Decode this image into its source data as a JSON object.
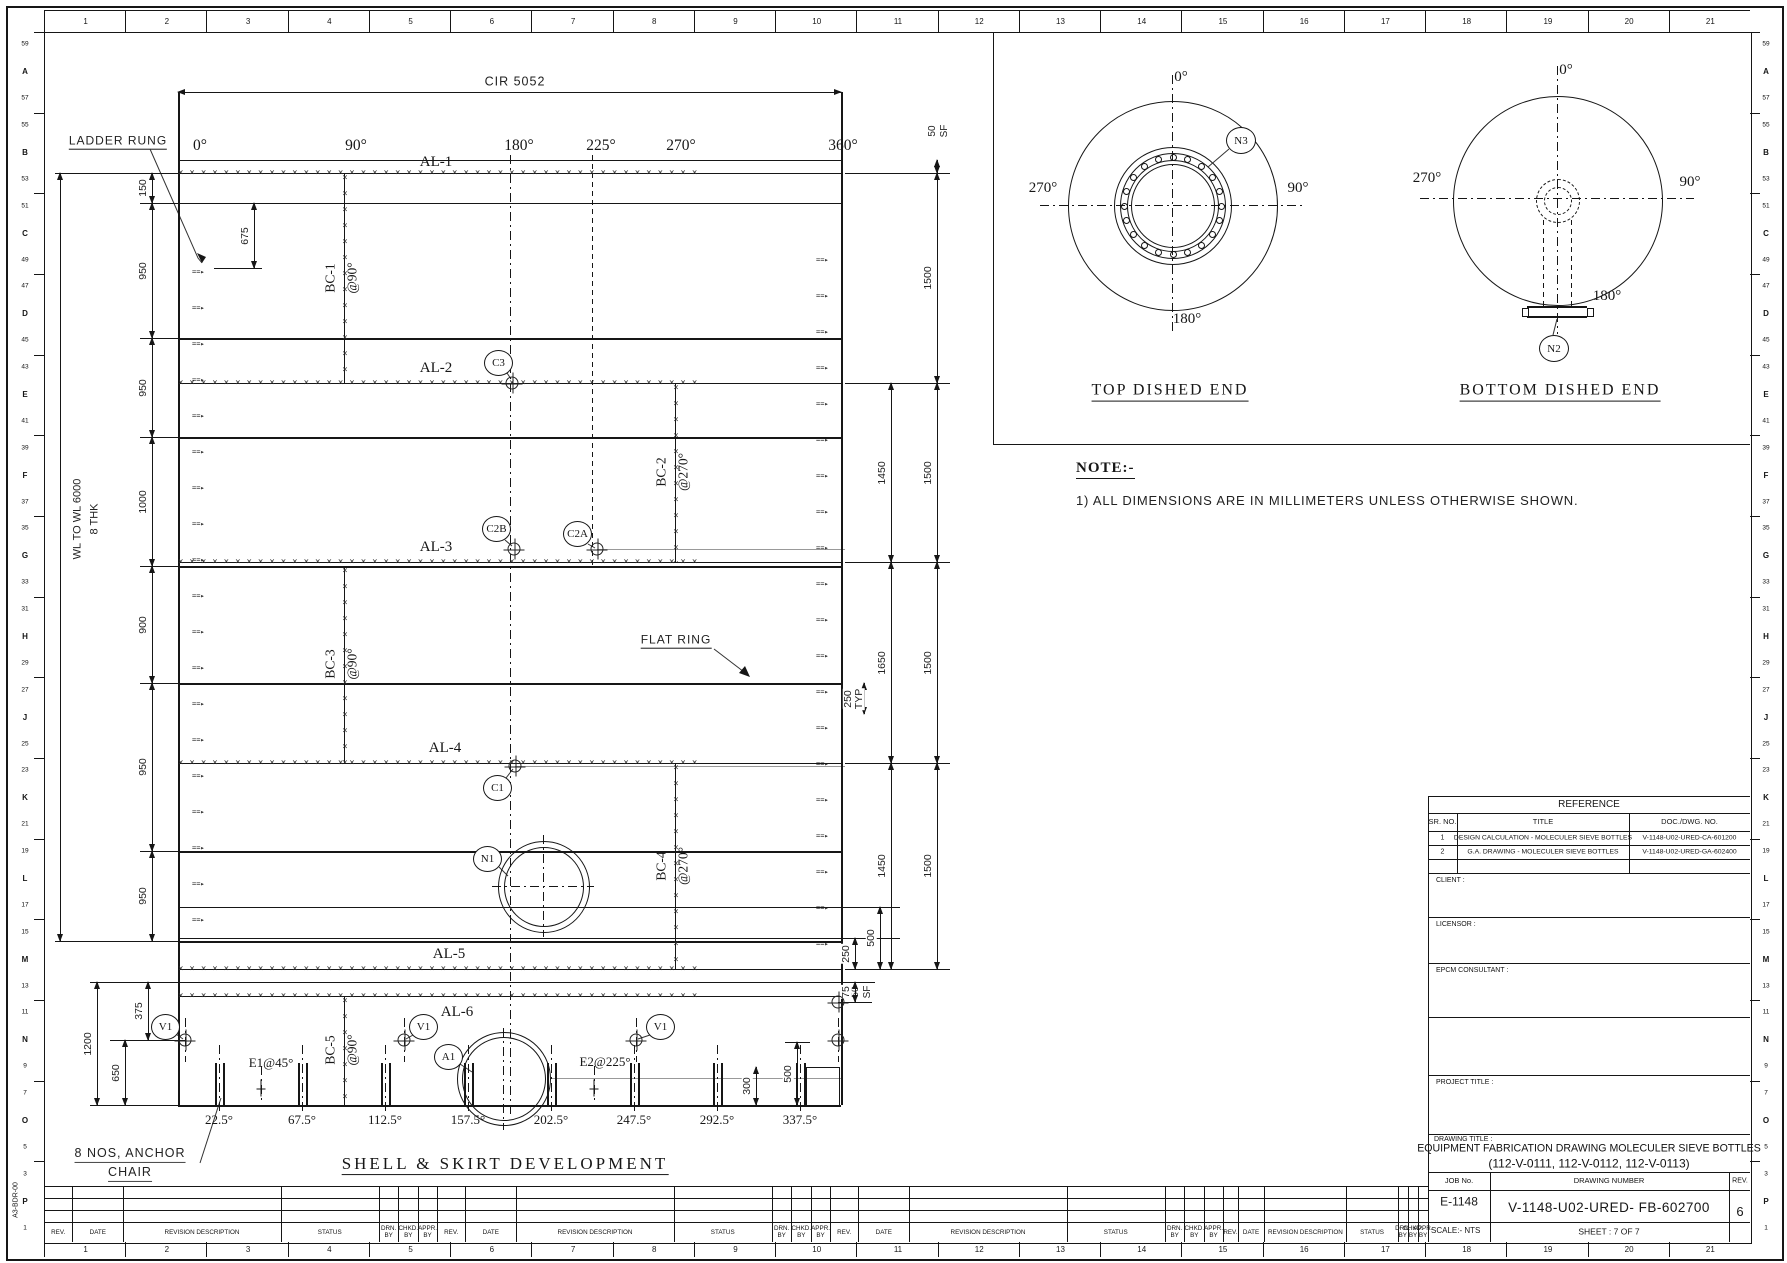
{
  "sheet": {
    "column_labels": [
      "1",
      "2",
      "3",
      "4",
      "5",
      "6",
      "7",
      "8",
      "9",
      "10",
      "11",
      "12",
      "13",
      "14",
      "15",
      "16",
      "17",
      "18",
      "19",
      "20",
      "21"
    ],
    "row_labels": [
      "59",
      "A",
      "57",
      "55",
      "B",
      "53",
      "51",
      "C",
      "49",
      "47",
      "D",
      "45",
      "43",
      "E",
      "41",
      "39",
      "F",
      "37",
      "35",
      "G",
      "33",
      "31",
      "H",
      "29",
      "27",
      "J",
      "25",
      "23",
      "K",
      "21",
      "19",
      "L",
      "17",
      "15",
      "M",
      "13",
      "11",
      "N",
      "9",
      "7",
      "O",
      "5",
      "3",
      "P",
      "1"
    ],
    "border_code": "A3-BDR-00"
  },
  "development": {
    "title": "SHELL & SKIRT DEVELOPMENT",
    "cir_label": "CIR 5052",
    "ladder_label": "LADDER RUNG",
    "flat_ring_label": "FLAT RING",
    "anchor_line1": "8 NOS, ANCHOR",
    "anchor_line2": "CHAIR",
    "wl_label": "WL TO WL 6000",
    "thk_label": "8 THK",
    "sf_label1": "50",
    "sf_label2": "SF",
    "e1_label": "E1@45°",
    "e2_label": "E2@225°",
    "top_angles": [
      {
        "t": "0°",
        "x": 200
      },
      {
        "t": "90°",
        "x": 356
      },
      {
        "t": "180°",
        "x": 519
      },
      {
        "t": "225°",
        "x": 601
      },
      {
        "t": "270°",
        "x": 681
      },
      {
        "t": "360°",
        "x": 843
      }
    ],
    "skirt_angles": [
      {
        "t": "22.5°",
        "x": 219
      },
      {
        "t": "67.5°",
        "x": 302
      },
      {
        "t": "112.5°",
        "x": 385
      },
      {
        "t": "157.5°",
        "x": 468
      },
      {
        "t": "202.5°",
        "x": 551
      },
      {
        "t": "247.5°",
        "x": 634
      },
      {
        "t": "292.5°",
        "x": 717
      },
      {
        "t": "337.5°",
        "x": 800
      }
    ],
    "seams": [
      {
        "t": "AL-1",
        "y": 173,
        "lx": 436,
        "ly": 163
      },
      {
        "t": "AL-2",
        "y": 383,
        "lx": 436,
        "ly": 369
      },
      {
        "t": "AL-3",
        "y": 562,
        "lx": 436,
        "ly": 548
      },
      {
        "t": "AL-4",
        "y": 763,
        "lx": 445,
        "ly": 749
      },
      {
        "t": "AL-5",
        "y": 969,
        "lx": 449,
        "ly": 955
      },
      {
        "t": "AL-6",
        "y": 996,
        "lx": 457,
        "ly": 1013
      }
    ],
    "bc_seams": [
      {
        "t1": "BC-1",
        "t2": "@90°",
        "x": 344,
        "y1": 173,
        "y2": 383,
        "ly": 278
      },
      {
        "t1": "BC-2",
        "t2": "@270°",
        "x": 675,
        "y1": 383,
        "y2": 562,
        "ly": 472
      },
      {
        "t1": "BC-3",
        "t2": "@90°",
        "x": 344,
        "y1": 566,
        "y2": 763,
        "ly": 664
      },
      {
        "t1": "BC-4",
        "t2": "@270°",
        "x": 675,
        "y1": 763,
        "y2": 969,
        "ly": 866
      },
      {
        "t1": "BC-5",
        "t2": "@90°",
        "x": 344,
        "y1": 996,
        "y2": 1105,
        "ly": 1050
      }
    ],
    "dims": [
      {
        "x": 60,
        "y1": 173,
        "y2": 941,
        "t": null
      },
      {
        "x": 152,
        "y1": 173,
        "y2": 203,
        "t": "150"
      },
      {
        "x": 152,
        "y1": 203,
        "y2": 338,
        "t": "950"
      },
      {
        "x": 152,
        "y1": 338,
        "y2": 437,
        "t": "950"
      },
      {
        "x": 152,
        "y1": 437,
        "y2": 566,
        "t": "1000"
      },
      {
        "x": 152,
        "y1": 566,
        "y2": 683,
        "t": "900"
      },
      {
        "x": 152,
        "y1": 683,
        "y2": 851,
        "t": "950"
      },
      {
        "x": 152,
        "y1": 851,
        "y2": 941,
        "t": "950"
      },
      {
        "x": 254,
        "y1": 203,
        "y2": 268,
        "t": "675"
      },
      {
        "x": 891,
        "y1": 383,
        "y2": 562,
        "t": "1450"
      },
      {
        "x": 891,
        "y1": 562,
        "y2": 763,
        "t": "1650"
      },
      {
        "x": 891,
        "y1": 763,
        "y2": 969,
        "t": "1450"
      },
      {
        "x": 937,
        "y1": 160,
        "y2": 173,
        "t": null
      },
      {
        "x": 937,
        "y1": 173,
        "y2": 383,
        "t": "1500"
      },
      {
        "x": 937,
        "y1": 383,
        "y2": 562,
        "t": "1500"
      },
      {
        "x": 937,
        "y1": 562,
        "y2": 763,
        "t": "1500"
      },
      {
        "x": 937,
        "y1": 763,
        "y2": 969,
        "t": "1500"
      },
      {
        "x": 864,
        "y1": 683,
        "y2": 714,
        "t": "250",
        "t2": "TYP"
      },
      {
        "x": 855,
        "y1": 938,
        "y2": 969,
        "t": "250"
      },
      {
        "x": 880,
        "y1": 907,
        "y2": 969,
        "t": "500"
      },
      {
        "x": 855,
        "y1": 982,
        "y2": 1002,
        "t": "75"
      },
      {
        "x": 148,
        "y1": 982,
        "y2": 1040,
        "t": "375"
      },
      {
        "x": 125,
        "y1": 1040,
        "y2": 1105,
        "t": "650"
      },
      {
        "x": 97,
        "y1": 982,
        "y2": 1105,
        "t": "1200"
      },
      {
        "x": 756,
        "y1": 1067,
        "y2": 1105,
        "t": "300"
      },
      {
        "x": 797,
        "y1": 1042,
        "y2": 1105,
        "t": "500"
      }
    ],
    "callouts": [
      {
        "t": "C3",
        "x": 498,
        "y": 362
      },
      {
        "t": "C2B",
        "x": 496,
        "y": 528
      },
      {
        "t": "C2A",
        "x": 577,
        "y": 533
      },
      {
        "t": "C1",
        "x": 497,
        "y": 787
      },
      {
        "t": "N1",
        "x": 487,
        "y": 858
      },
      {
        "t": "A1",
        "x": 448,
        "y": 1056
      },
      {
        "t": "V1",
        "x": 165,
        "y": 1026
      },
      {
        "t": "V1",
        "x": 423,
        "y": 1026
      },
      {
        "t": "V1",
        "x": 660,
        "y": 1026
      }
    ],
    "geo": {
      "h": [
        [
          178,
          841,
          160,
          1
        ],
        [
          178,
          841,
          203,
          1
        ],
        [
          178,
          841,
          338,
          2
        ],
        [
          178,
          841,
          437,
          2
        ],
        [
          178,
          841,
          566,
          2
        ],
        [
          178,
          841,
          683,
          2
        ],
        [
          178,
          841,
          851,
          2
        ],
        [
          178,
          841,
          907,
          1
        ],
        [
          178,
          841,
          938,
          1
        ],
        [
          178,
          841,
          941,
          2
        ],
        [
          178,
          841,
          982,
          1
        ],
        [
          178,
          841,
          1105,
          2
        ],
        [
          845,
          950,
          173,
          1
        ],
        [
          845,
          950,
          383,
          1
        ],
        [
          845,
          950,
          562,
          1
        ],
        [
          845,
          950,
          763,
          1
        ],
        [
          845,
          950,
          969,
          1
        ],
        [
          841,
          900,
          907,
          1
        ],
        [
          841,
          900,
          938,
          1
        ],
        [
          841,
          875,
          982,
          1
        ],
        [
          838,
          872,
          1002,
          1
        ],
        [
          55,
          178,
          173,
          1
        ],
        [
          55,
          178,
          941,
          1
        ],
        [
          140,
          178,
          203,
          1
        ],
        [
          140,
          178,
          338,
          1
        ],
        [
          140,
          178,
          437,
          1
        ],
        [
          140,
          178,
          566,
          1
        ],
        [
          140,
          178,
          683,
          1
        ],
        [
          140,
          178,
          851,
          1
        ],
        [
          90,
          178,
          982,
          1
        ],
        [
          110,
          185,
          1040,
          1
        ],
        [
          90,
          178,
          1105,
          1
        ],
        [
          214,
          262,
          268,
          1
        ],
        [
          806,
          839,
          1067,
          1
        ],
        [
          785,
          810,
          1042,
          1
        ],
        [
          993,
          1750,
          444,
          1
        ]
      ],
      "hg": [
        [
          597,
          845,
          549
        ],
        [
          515,
          845,
          766
        ],
        [
          550,
          841,
          1078
        ]
      ],
      "v": [
        [
          92,
          1105,
          178,
          2
        ],
        [
          92,
          1105,
          841,
          2
        ],
        [
          32,
          444,
          993,
          1
        ],
        [
          1067,
          1105,
          806,
          1
        ],
        [
          1067,
          1105,
          839,
          1
        ],
        [
          796,
          1242,
          1428,
          1
        ]
      ],
      "ddv": [
        [
          155,
          1115,
          510
        ],
        [
          1018,
          1062,
          185
        ],
        [
          1018,
          1062,
          404
        ],
        [
          1018,
          1062,
          636
        ],
        [
          1018,
          1062,
          838
        ],
        [
          1066,
          1102,
          261
        ],
        [
          1066,
          1102,
          594
        ],
        [
          835,
          937,
          543
        ],
        [
          1028,
          1130,
          503
        ]
      ],
      "dshv": [
        [
          155,
          568,
          592
        ]
      ],
      "ddh": [
        [
          492,
          594,
          886
        ]
      ],
      "oplus": [
        [
          512,
          383
        ],
        [
          514,
          549
        ],
        [
          597,
          549
        ],
        [
          515,
          766
        ],
        [
          185,
          1040
        ],
        [
          404,
          1040
        ],
        [
          636,
          1040
        ],
        [
          838,
          1040
        ],
        [
          838,
          1002
        ]
      ],
      "ecross": [
        [
          261,
          1088
        ],
        [
          594,
          1088
        ]
      ],
      "chairs": [
        219,
        302,
        385,
        468,
        551,
        634,
        717,
        800
      ],
      "rungs_left": {
        "x": 192,
        "y0": 272,
        "step": 36,
        "n": 19
      },
      "rungs_right": {
        "x": 816,
        "y0": 260,
        "step": 36,
        "n": 20
      },
      "nozzles": [
        {
          "x": 543,
          "y": 886,
          "r1": 45,
          "r2": 39
        },
        {
          "x": 503,
          "y": 1078,
          "r1": 46,
          "r2": 41
        }
      ]
    }
  },
  "views": {
    "top": {
      "title": "TOP DISHED END",
      "a0": "0°",
      "a90": "90°",
      "a180": "180°",
      "a270": "270°",
      "nozzle": "N3"
    },
    "bottom": {
      "title": "BOTTOM DISHED END",
      "a0": "0°",
      "a90": "90°",
      "a180": "180°",
      "a270": "270°",
      "nozzle": "N2"
    }
  },
  "note": {
    "heading": "NOTE:-",
    "item1": "1) ALL DIMENSIONS ARE IN MILLIMETERS UNLESS OTHERWISE SHOWN."
  },
  "reference": {
    "title": "REFERENCE",
    "headers": [
      "SR. NO.",
      "TITLE",
      "DOC./DWG. NO."
    ],
    "rows": [
      [
        "1",
        "DESIGN CALCULATION -  MOLECULER SIEVE BOTTLES",
        "V-1148-U02-URED-CA-601200"
      ],
      [
        "2",
        "G.A. DRAWING - MOLECULER SIEVE BOTTLES",
        "V-1148-U02-URED-GA-602400"
      ],
      [
        "",
        "",
        ""
      ]
    ]
  },
  "title_block": {
    "client_label": "CLIENT :",
    "licensor_label": "LICENSOR :",
    "epcm_label": "EPCM CONSULTANT :",
    "project_label": "PROJECT TITLE :",
    "drawing_title_label": "DRAWING TITLE :",
    "drawing_title_line1": "EQUIPMENT FABRICATION DRAWING MOLECULER SIEVE BOTTLES",
    "drawing_title_line2": "(112-V-0111, 112-V-0112, 112-V-0113)",
    "job_label": "JOB No.",
    "job_no": "E-1148",
    "drawing_number_label": "DRAWING NUMBER",
    "drawing_number": "V-1148-U02-URED- FB-602700",
    "rev_label": "REV.",
    "rev": "6",
    "scale_label": "SCALE:- NTS",
    "sheet_label": "SHEET : 7 OF 7"
  },
  "revision_strip": {
    "headers": [
      "REV.",
      "DATE",
      "REVISION DESCRIPTION",
      "STATUS",
      "DRN.\nBY",
      "CHKD.\nBY",
      "APPR.\nBY"
    ]
  }
}
